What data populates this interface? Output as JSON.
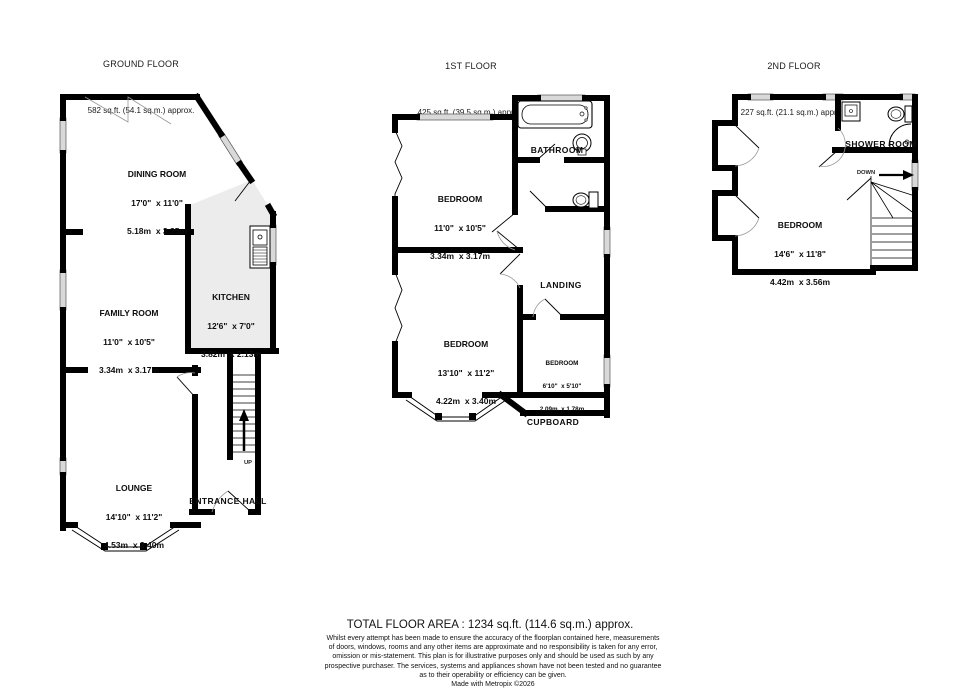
{
  "floors": {
    "ground": {
      "title": "GROUND FLOOR",
      "area": "582 sq.ft. (54.1 sq.m.) approx.",
      "rooms": {
        "dining": {
          "name": "DINING ROOM",
          "imperial": "17'0\"  x 11'0\"",
          "metric": "5.18m  x 3.35m"
        },
        "family": {
          "name": "FAMILY ROOM",
          "imperial": "11'0\"  x 10'5\"",
          "metric": "3.34m  x 3.17m"
        },
        "kitchen": {
          "name": "KITCHEN",
          "imperial": "12'6\"  x 7'0\"",
          "metric": "3.82m  x 2.13m"
        },
        "lounge": {
          "name": "LOUNGE",
          "imperial": "14'10\"  x 11'2\"",
          "metric": "4.53m  x 3.40m"
        },
        "hall": {
          "name": "ENTRANCE HALL"
        }
      },
      "stairs_label": "UP"
    },
    "first": {
      "title": "1ST FLOOR",
      "area": "425 sq.ft. (39.5 sq.m.) approx.",
      "rooms": {
        "bathroom": {
          "name": "BATHROOM"
        },
        "bedroom1": {
          "name": "BEDROOM",
          "imperial": "11'0\"  x 10'5\"",
          "metric": "3.34m  x 3.17m"
        },
        "landing": {
          "name": "LANDING"
        },
        "bedroom2": {
          "name": "BEDROOM",
          "imperial": "13'10\"  x 11'2\"",
          "metric": "4.22m  x 3.40m"
        },
        "bedroom3": {
          "name": "BEDROOM",
          "imperial": "6'10\"  x 5'10\"",
          "metric": "2.09m  x 1.78m"
        },
        "cupboard": {
          "name": "CUPBOARD"
        }
      }
    },
    "second": {
      "title": "2ND FLOOR",
      "area": "227 sq.ft. (21.1 sq.m.) approx.",
      "rooms": {
        "shower": {
          "name": "SHOWER ROOM"
        },
        "bedroom": {
          "name": "BEDROOM",
          "imperial": "14'6\"  x 11'8\"",
          "metric": "4.42m  x 3.56m"
        }
      },
      "stairs_label": "DOWN"
    }
  },
  "footer": {
    "total": "TOTAL FLOOR AREA : 1234 sq.ft. (114.6 sq.m.) approx.",
    "disclaimer": [
      "Whilst every attempt has been made to ensure the accuracy of the floorplan contained here, measurements",
      "of doors, windows, rooms and any other items are approximate and no responsibility is taken for any error,",
      "omission or mis-statement. This plan is for illustrative purposes only and should be used as such by any",
      "prospective purchaser. The services, systems and appliances shown have not been tested and no guarantee",
      "as to their operability or efficiency can be given."
    ],
    "credit": "Made with Metropix ©2026"
  },
  "colors": {
    "wall": "#000000",
    "window": "#d9d9d9",
    "kitchen_floor": "#ececec"
  }
}
